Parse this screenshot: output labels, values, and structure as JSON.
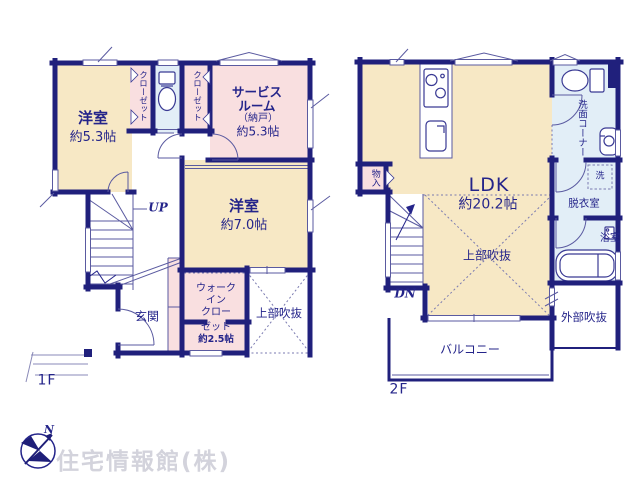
{
  "watermark": "住宅情報館(株)",
  "compass": {
    "north": "N"
  },
  "colors": {
    "wall": "#20207c",
    "thin_line": "#5a5aa0",
    "room_cream": "#f7e8c5",
    "room_pink": "#f9dfe0",
    "room_blue": "#e2eef7",
    "text": "#24248a",
    "watermark": "#d3d3dc"
  },
  "floor1": {
    "floor_label": "1F",
    "room53": {
      "name": "洋室",
      "size": "約5.3帖"
    },
    "closet_left": {
      "label": "クローゼット"
    },
    "closet_right": {
      "label": "クローゼット"
    },
    "service_room": {
      "line1": "サービス",
      "line2": "ルーム",
      "line3": "（納戸）",
      "line4": "約5.3帖"
    },
    "room70": {
      "name": "洋室",
      "size": "約7.0帖"
    },
    "stairs": {
      "label": "UP"
    },
    "entrance": {
      "label": "玄関"
    },
    "wic": {
      "line1": "ウォーク",
      "line2": "イン",
      "line3": "クロー",
      "line4": "ゼット",
      "line5": "約2.5帖"
    },
    "void": {
      "label": "上部吹抜"
    }
  },
  "floor2": {
    "floor_label": "2F",
    "ldk": {
      "name": "LDK",
      "size": "約20.2帖"
    },
    "void": {
      "label": "上部吹抜"
    },
    "storage": {
      "label": "物入"
    },
    "stairs": {
      "label": "DN"
    },
    "wash_corner": {
      "label": "洗面コーナー"
    },
    "laundry": {
      "label": "洗"
    },
    "dressing_room": {
      "label": "脱衣室"
    },
    "bathroom": {
      "label": "浴室"
    },
    "outer_void": {
      "label": "外部吹抜"
    },
    "balcony": {
      "label": "バルコニー"
    }
  }
}
